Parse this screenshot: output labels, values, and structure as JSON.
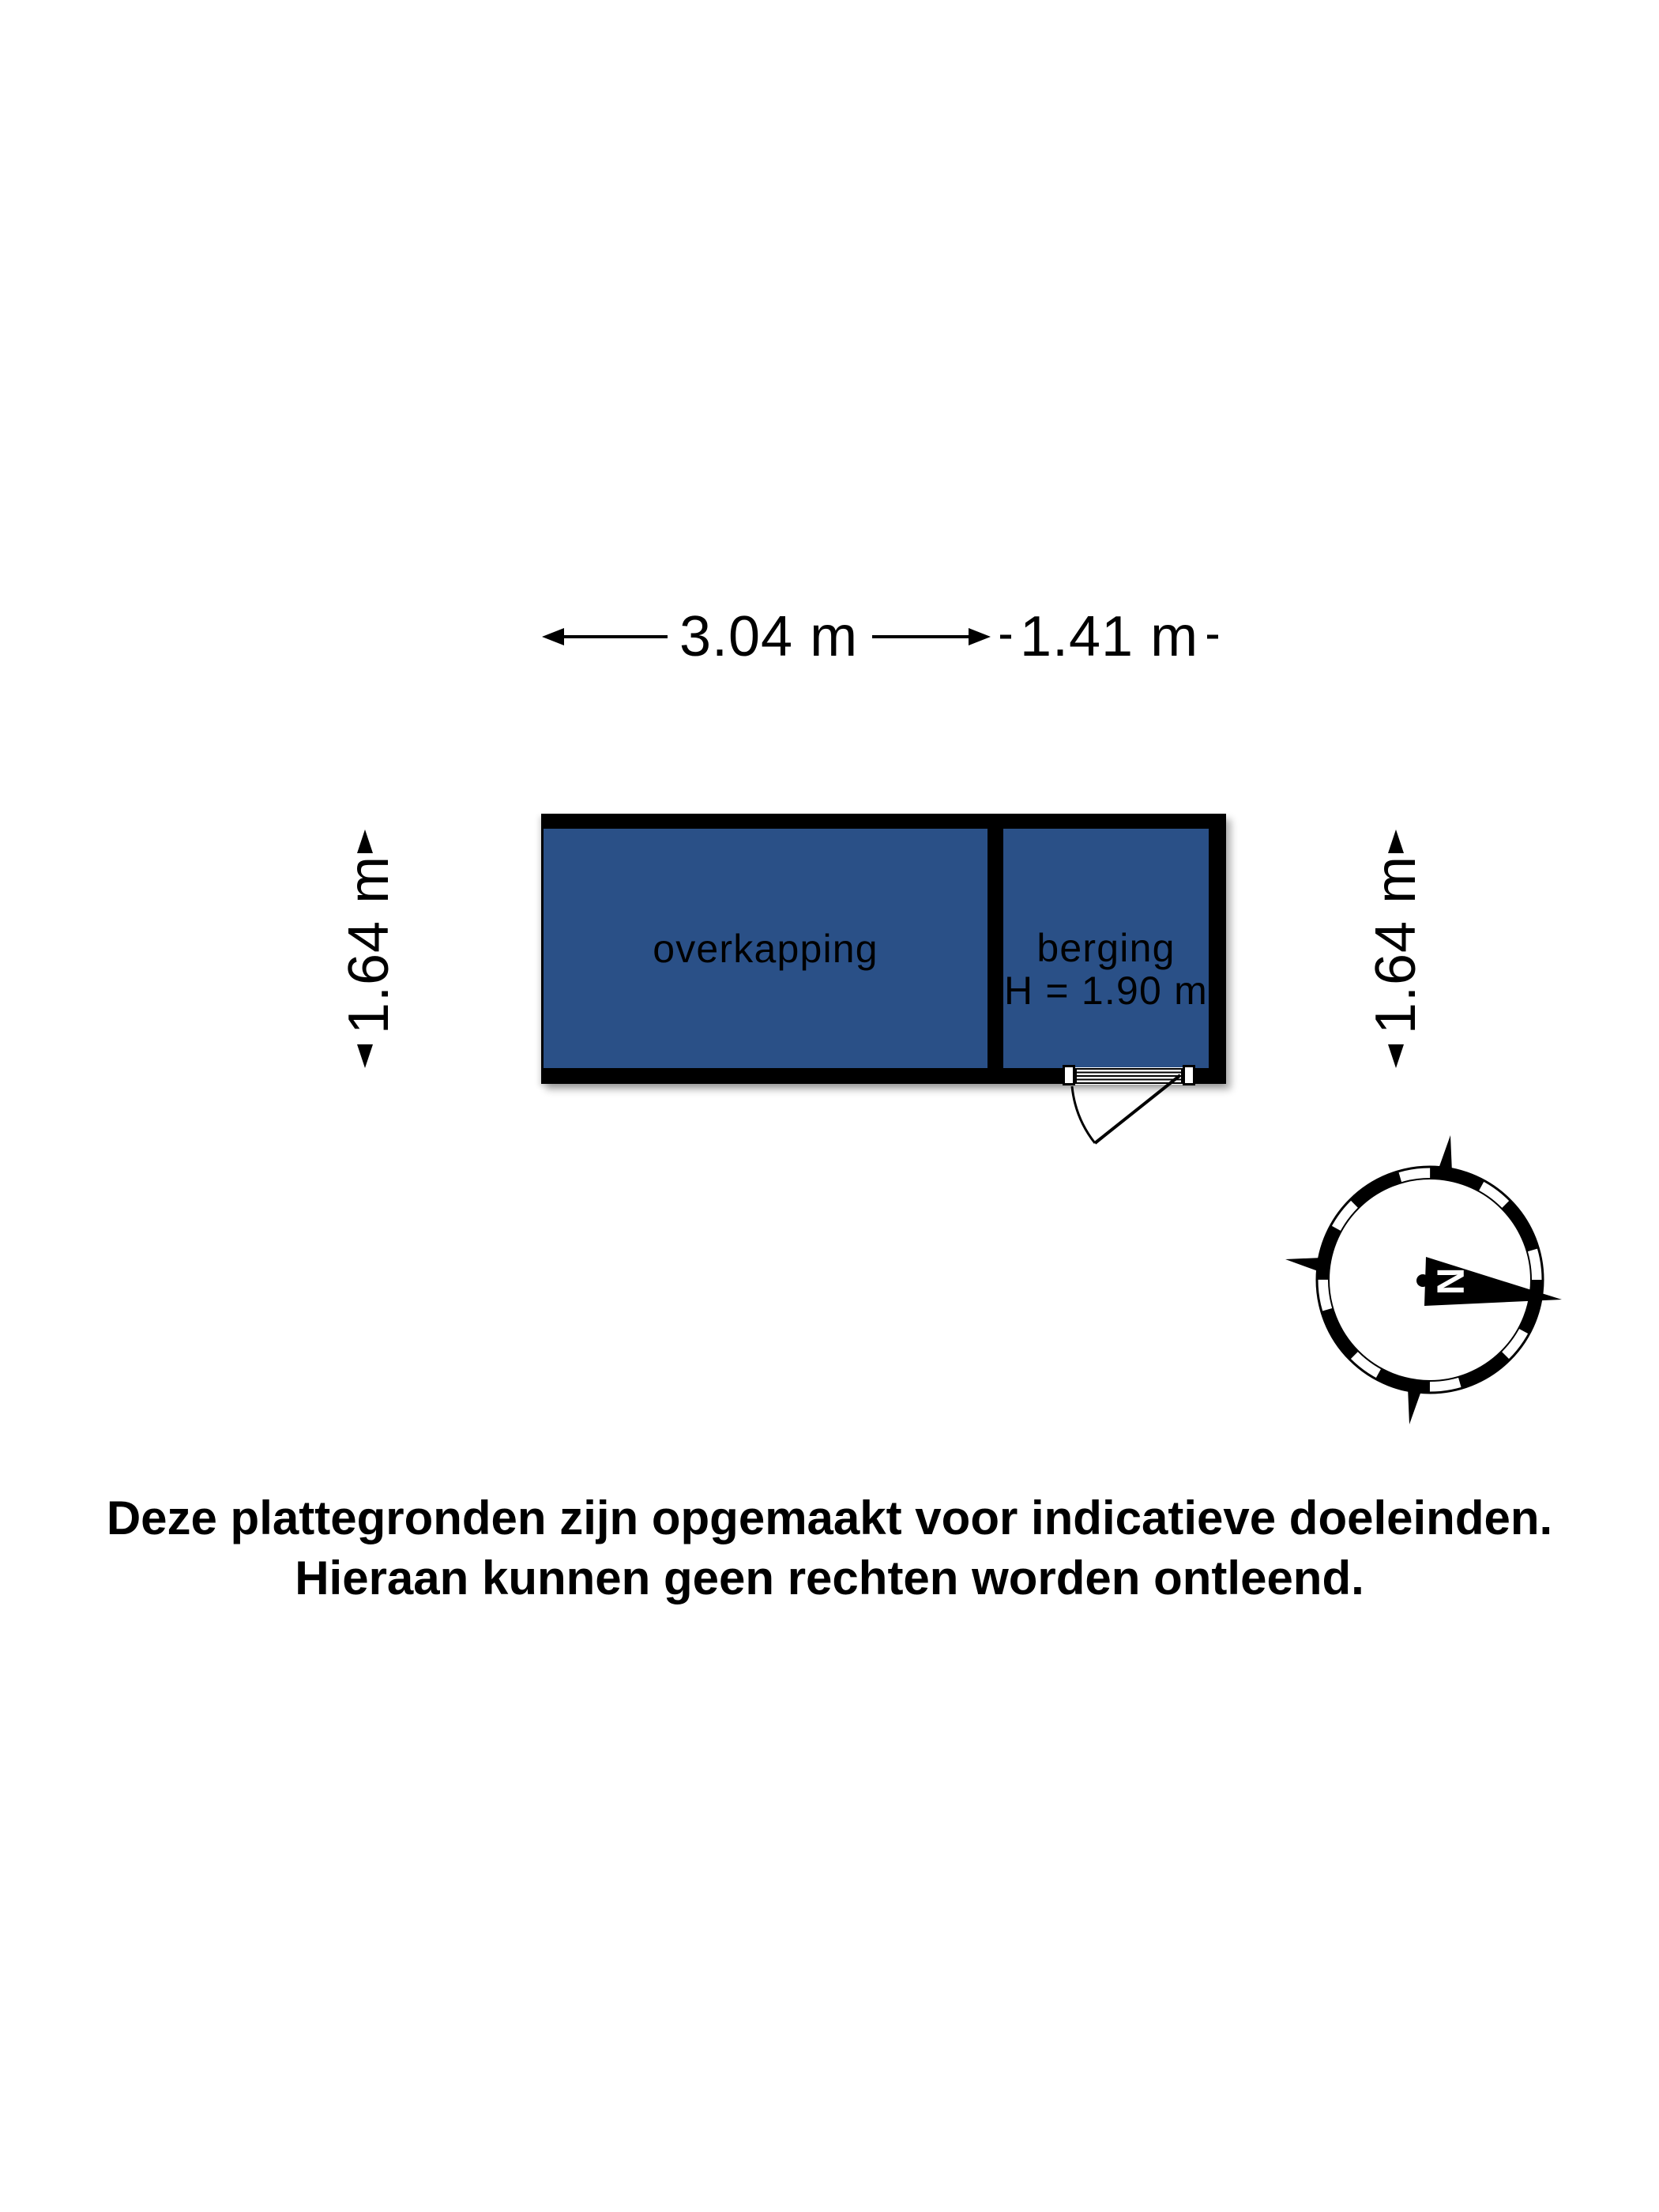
{
  "plan": {
    "dimensions": {
      "top_width_overkapping": "3.04 m",
      "top_width_berging": "1.41 m",
      "side_left": "1.64 m",
      "side_right": "1.64 m"
    },
    "rooms": {
      "overkapping": {
        "label": "overkapping"
      },
      "berging": {
        "label": "berging",
        "height": "H = 1.90 m"
      }
    },
    "compass": {
      "north_letter": "N"
    }
  },
  "disclaimer": {
    "line1": "Deze plattegronden zijn opgemaakt voor indicatieve doeleinden.",
    "line2": "Hieraan kunnen geen rechten worden ontleend."
  },
  "colors": {
    "background": "#FFFFFF",
    "wall": "#000000",
    "room_fill": "#2A5087",
    "text": "#000000"
  }
}
